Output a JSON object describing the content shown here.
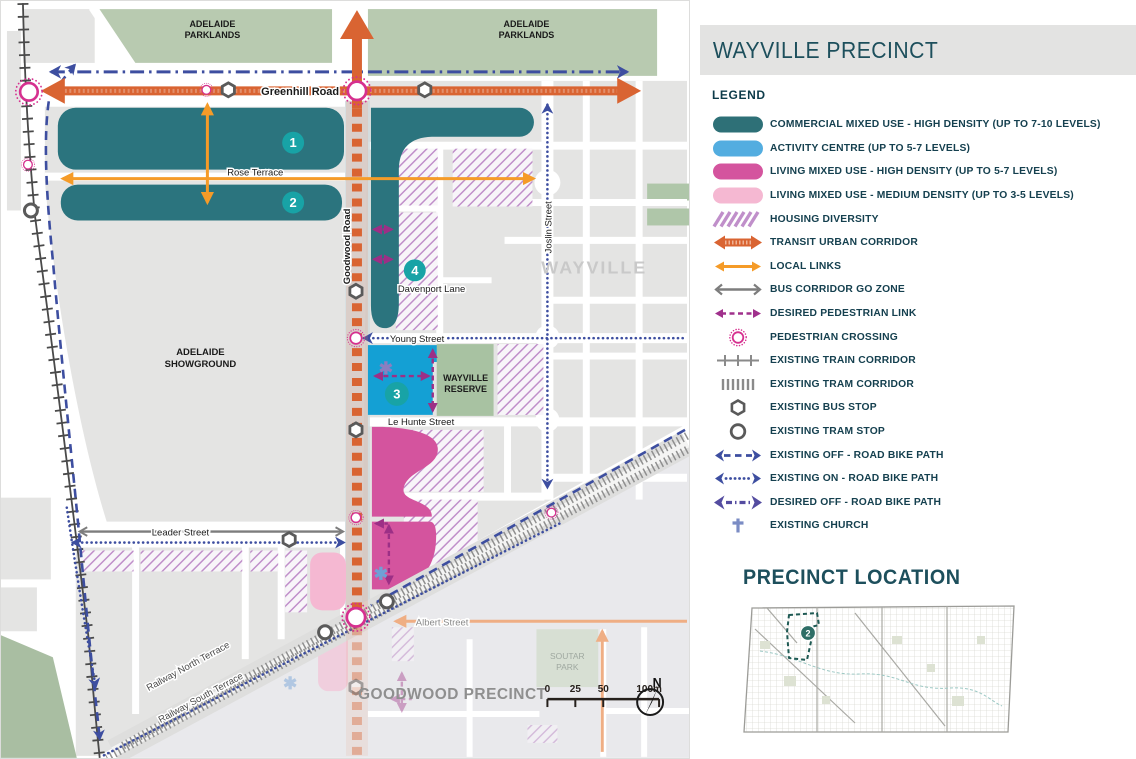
{
  "panel": {
    "title": "WAYVILLE PRECINCT",
    "legend_title": "LEGEND",
    "location_title": "PRECINCT LOCATION",
    "location_badge": "2"
  },
  "legend": {
    "items": [
      {
        "icon": "commercial-swatch",
        "label": "COMMERCIAL MIXED USE - HIGH DENSITY (UP TO 7-10 LEVELS)"
      },
      {
        "icon": "activity-centre-swatch",
        "label": "ACTIVITY CENTRE (UP TO 5-7 LEVELS)"
      },
      {
        "icon": "living-high-swatch",
        "label": "LIVING MIXED USE - HIGH DENSITY (UP TO 5-7 LEVELS)"
      },
      {
        "icon": "living-medium-swatch",
        "label": "LIVING MIXED USE - MEDIUM DENSITY (UP TO 3-5 LEVELS)"
      },
      {
        "icon": "housing-diversity-swatch",
        "label": "HOUSING DIVERSITY"
      },
      {
        "icon": "transit-urban-corridor-icon",
        "label": "TRANSIT URBAN CORRIDOR"
      },
      {
        "icon": "local-links-icon",
        "label": "LOCAL LINKS"
      },
      {
        "icon": "bus-corridor-icon",
        "label": "BUS CORRIDOR GO ZONE"
      },
      {
        "icon": "desired-pedestrian-link-icon",
        "label": "DESIRED PEDESTRIAN LINK"
      },
      {
        "icon": "pedestrian-crossing-icon",
        "label": "PEDESTRIAN CROSSING"
      },
      {
        "icon": "train-corridor-icon",
        "label": "EXISTING TRAIN CORRIDOR"
      },
      {
        "icon": "tram-corridor-icon",
        "label": "EXISTING TRAM CORRIDOR"
      },
      {
        "icon": "bus-stop-icon",
        "label": "EXISTING BUS STOP"
      },
      {
        "icon": "tram-stop-icon",
        "label": "EXISTING TRAM STOP"
      },
      {
        "icon": "off-road-bike-icon",
        "label": "EXISTING OFF - ROAD BIKE PATH"
      },
      {
        "icon": "on-road-bike-icon",
        "label": "EXISTING ON - ROAD BIKE PATH"
      },
      {
        "icon": "desired-off-road-bike-icon",
        "label": "DESIRED OFF - ROAD BIKE PATH"
      },
      {
        "icon": "church-icon",
        "label": "EXISTING CHURCH"
      }
    ]
  },
  "map": {
    "areas": {
      "parklands": {
        "line1": "ADELAIDE",
        "line2": "PARKLANDS"
      },
      "showground": {
        "line1": "ADELAIDE",
        "line2": "SHOWGROUND"
      },
      "reserve": {
        "line1": "WAYVILLE",
        "line2": "RESERVE"
      },
      "soutar": {
        "line1": "SOUTAR",
        "line2": "PARK"
      },
      "suburb": "WAYVILLE",
      "goodwood": "GOODWOOD PRECINCT"
    },
    "streets": {
      "greenhill": "Greenhill Road",
      "rose": "Rose Terrace",
      "davenport": "Davenport Lane",
      "young": "Young Street",
      "lehunte": "Le Hunte Street",
      "leader": "Leader Street",
      "albert": "Albert Street",
      "joslin": "Joslin Street",
      "goodwood_road": "Goodwood Road",
      "railway_north": "Railway North Terrace",
      "railway_south": "Railway South Terrace"
    },
    "markers": [
      "1",
      "2",
      "3",
      "4"
    ],
    "compass": "N",
    "scale": {
      "t0": "0",
      "t25": "25",
      "t50": "50",
      "t100": "100m"
    }
  },
  "colors": {
    "commercial_teal": "#2B747E",
    "activity_blue": "#53ADE0",
    "activity_map_blue": "#14A0D4",
    "living_high": "#D4549E",
    "living_medium": "#F5B8D2",
    "housing_hatch": "#C08FCA",
    "transit_orange": "#D96432",
    "local_link_orange": "#F59B28",
    "bus_gray": "#7D7D7D",
    "pedestrian_link": "#9C2F86",
    "crossing_magenta": "#D6308F",
    "bike_blue": "#3D4EA0",
    "desired_bike_purple": "#544CA0",
    "church_blue": "#7B8CC4",
    "parkland_green": "#B8CAB0",
    "reserve_green": "#A8C2A2",
    "block_gray": "#E4E4E3",
    "marker_teal": "#18A3A6",
    "header_text": "#1D4F5C",
    "legend_text": "#15404F"
  }
}
